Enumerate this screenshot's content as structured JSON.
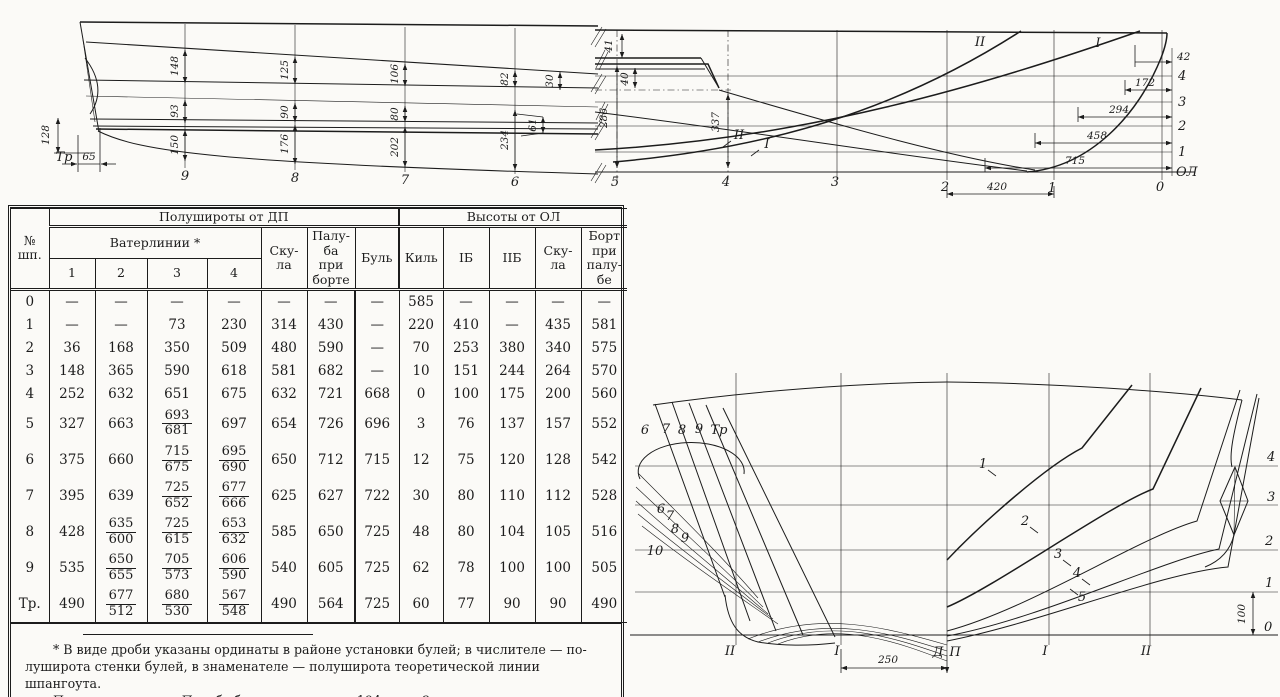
{
  "table": {
    "corner": "№\nшп.",
    "group_left": "Полушироты от ДП",
    "group_right": "Высоты от ОЛ",
    "waterlines": "Ватерлинии *",
    "wl_nums": [
      "1",
      "2",
      "3",
      "4"
    ],
    "cols_left": [
      "Ску-\nла",
      "Палу-\nба\nпри\nборте",
      "Буль"
    ],
    "cols_right": [
      "Киль",
      "IБ",
      "IIБ",
      "Ску-\nла",
      "Борт\nпри\nпалу-\nбе"
    ],
    "rows": [
      [
        "0",
        "—",
        "—",
        "—",
        "—",
        "—",
        "—",
        "—",
        "585",
        "—",
        "—",
        "—",
        "—"
      ],
      [
        "1",
        "—",
        "—",
        "73",
        "230",
        "314",
        "430",
        "—",
        "220",
        "410",
        "—",
        "435",
        "581"
      ],
      [
        "2",
        "36",
        "168",
        "350",
        "509",
        "480",
        "590",
        "—",
        "70",
        "253",
        "380",
        "340",
        "575"
      ],
      [
        "3",
        "148",
        "365",
        "590",
        "618",
        "581",
        "682",
        "—",
        "10",
        "151",
        "244",
        "264",
        "570"
      ],
      [
        "4",
        "252",
        "632",
        "651",
        "675",
        "632",
        "721",
        "668",
        "0",
        "100",
        "175",
        "200",
        "560"
      ],
      [
        "5",
        "327",
        "663",
        "693/681",
        "697",
        "654",
        "726",
        "696",
        "3",
        "76",
        "137",
        "157",
        "552"
      ],
      [
        "6",
        "375",
        "660",
        "715/675",
        "695/690",
        "650",
        "712",
        "715",
        "12",
        "75",
        "120",
        "128",
        "542"
      ],
      [
        "7",
        "395",
        "639",
        "725/652",
        "677/666",
        "625",
        "627",
        "722",
        "30",
        "80",
        "110",
        "112",
        "528"
      ],
      [
        "8",
        "428",
        "635/600",
        "725/615",
        "653/632",
        "585",
        "650",
        "725",
        "48",
        "80",
        "104",
        "105",
        "516"
      ],
      [
        "9",
        "535",
        "650/655",
        "705/573",
        "606/590",
        "540",
        "605",
        "725",
        "62",
        "78",
        "100",
        "100",
        "505"
      ],
      [
        "Тр.",
        "490",
        "677/512",
        "680/530",
        "567/548",
        "490",
        "564",
        "725",
        "60",
        "77",
        "90",
        "90",
        "490"
      ]
    ],
    "footnote1": "* В виде дроби указаны ординаты в районе установки булей; в числителе — по-",
    "footnote2": "луширота стенки булей, в знаменателе — полуширота теоретической линии шпангоута.",
    "note": "П р и м е ч а н и е.  Погибь бимсов — см. стр. 194, вып. 2."
  },
  "plan": {
    "stations": [
      "9",
      "8",
      "7",
      "6"
    ],
    "tr": "Тр",
    "d148": "148",
    "d93": "93",
    "d150": "150",
    "d125": "125",
    "d90": "90",
    "d176": "176",
    "d106": "106",
    "d80": "80",
    "d202": "202",
    "d82": "82",
    "d234": "234",
    "d61": "61",
    "d30": "30",
    "d128": "128",
    "d65": "65"
  },
  "profile": {
    "stations": [
      "5",
      "4",
      "3",
      "2",
      "1",
      "0"
    ],
    "wl": [
      "4",
      "3",
      "2",
      "1",
      "ОЛ"
    ],
    "butt_top": [
      "II",
      "I"
    ],
    "butt_mid": [
      "II",
      "I"
    ],
    "d41": "41",
    "d286": "286",
    "d40": "40",
    "d337": "337",
    "d42": "42",
    "d172": "172",
    "d294": "294",
    "d458": "458",
    "d715": "715",
    "d420": "420"
  },
  "body": {
    "aft_top": [
      "6",
      "7",
      "8",
      "9",
      "Тр"
    ],
    "aft_low": [
      "6",
      "7",
      "8",
      "9",
      "10"
    ],
    "fore": [
      "1",
      "2",
      "3",
      "4",
      "5"
    ],
    "wl": [
      "4",
      "3",
      "2",
      "1",
      "0"
    ],
    "axes": [
      "II",
      "I",
      "Д",
      "П",
      "I",
      "II"
    ],
    "d250": "250",
    "d100": "100"
  }
}
